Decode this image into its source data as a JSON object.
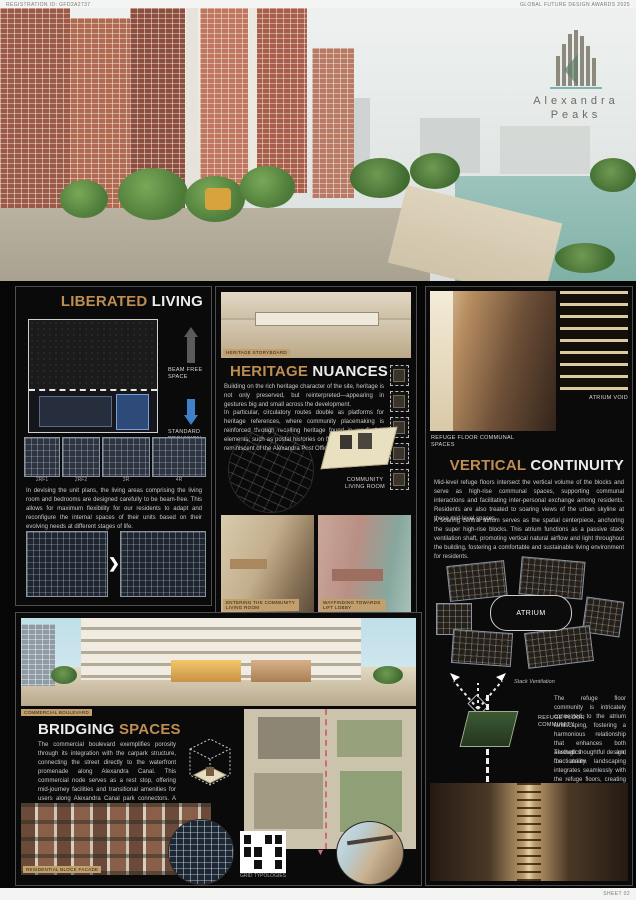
{
  "header": {
    "registration_id": "REGISTRATION ID: GFD2A2737",
    "award": "GLOBAL FUTURE DESIGN AWARDS 2025"
  },
  "logo": {
    "line1": "Alexandra",
    "line2": "Peaks"
  },
  "panels": {
    "liberated_living": {
      "title_accent": "LIBERATED",
      "title_rest": " LIVING",
      "beam_free_label": "BEAM FREE SPACE",
      "standard_label": "STANDARD PROVISION",
      "plan_labels": [
        "2RF1",
        "2RF2",
        "3R",
        "4R"
      ],
      "body": "In devising the unit plans, the living areas comprising the living room and bedrooms are designed carefully to be beam-free. This allows for maximum flexibility for our residents to adapt and reconfigure the internal spaces of their units based on their evolving needs at different stages of life."
    },
    "heritage_nuances": {
      "image_label": "HERITAGE STORYBOARD",
      "title_accent": "HERITAGE",
      "title_rest": " NUANCES",
      "para1": "Building on the rich heritage character of the site, heritage is not only preserved, but reinterpreted—appearing in gestures big and small across the development.",
      "para2": "In particular, circulatory routes double as platforms for heritage references, where community placemaking is reinforced through recalling heritage found in wayfinding elements, such as postal histories on floor markers that are reminiscent of the Alexandra Post Office.",
      "axon_label": "COMMUNITY LIVING ROOM",
      "photo1_label": "ENTERING THE COMMUNITY LIVING ROOM",
      "photo2_label": "WAYFINDING TOWARDS LIFT LOBBY"
    },
    "vertical_continuity": {
      "atrium_void_label": "ATRIUM VOID",
      "refuge_label": "REFUGE FLOOR COMMUNAL SPACES",
      "title_accent": "VERTICAL",
      "title_rest": " CONTINUITY",
      "para1": "Mid-level refuge floors intersect the vertical volume of the blocks and serve as high-rise communal spaces, supporting communal interactions and facilitating inter-personal exchange among residents. Residents are also treated to soaring views of the urban skyline at these mid-level spaces.",
      "para2": "A soaring central atrium serves as the spatial centerpiece, anchoring the super high-rise blocks. This atrium functions as a passive stack ventilation shaft, promoting vertical natural airflow and light throughout the building, fostering a comfortable and sustainable living environment for residents.",
      "atrium_plan_label": "ATRIUM",
      "stack_label": "Stack Ventilation",
      "axon_top_label": "REFUGE FLOOR COMMUNITY",
      "axon_bottom_label": "ATRIUM LANDSCAPE",
      "para3": "The refuge floor community is intricately connected to the atrium landscaping, fostering a harmonious relationship that enhances both aesthetics and functionality.",
      "para4": "Through thoughtful design, the atrium landscaping integrates seamlessly with the refuge floors, creating a tranquil oasis amidst the urban environment."
    },
    "bridging_spaces": {
      "image_label": "COMMERCIAL BOULEVARD",
      "title_rest": "BRIDGING",
      "title_accent": " SPACES",
      "body": "The commercial boulevard exemplifies porosity through its integration with the carpark structure, connecting the street directly to the waterfront promenade along Alexandra Canal. This commercial node serves as a rest stop, offering mid-journey facilities and transitional amenities for users along Alexandra Canal park connectors. A calm pause along the journey, we designed this space to welcome the wider community with thoughtful community provisions and a place to recharge.",
      "facade_label": "RESIDENTIAL BLOCK FACADE",
      "grid_label": "GRID TYPOLOGIES"
    }
  },
  "footer": {
    "sheet": "SHEET 02"
  },
  "colors": {
    "accent": "#bd8d52",
    "blue_arrow": "#3f80c8",
    "chip_bg": "#c2a06e"
  }
}
